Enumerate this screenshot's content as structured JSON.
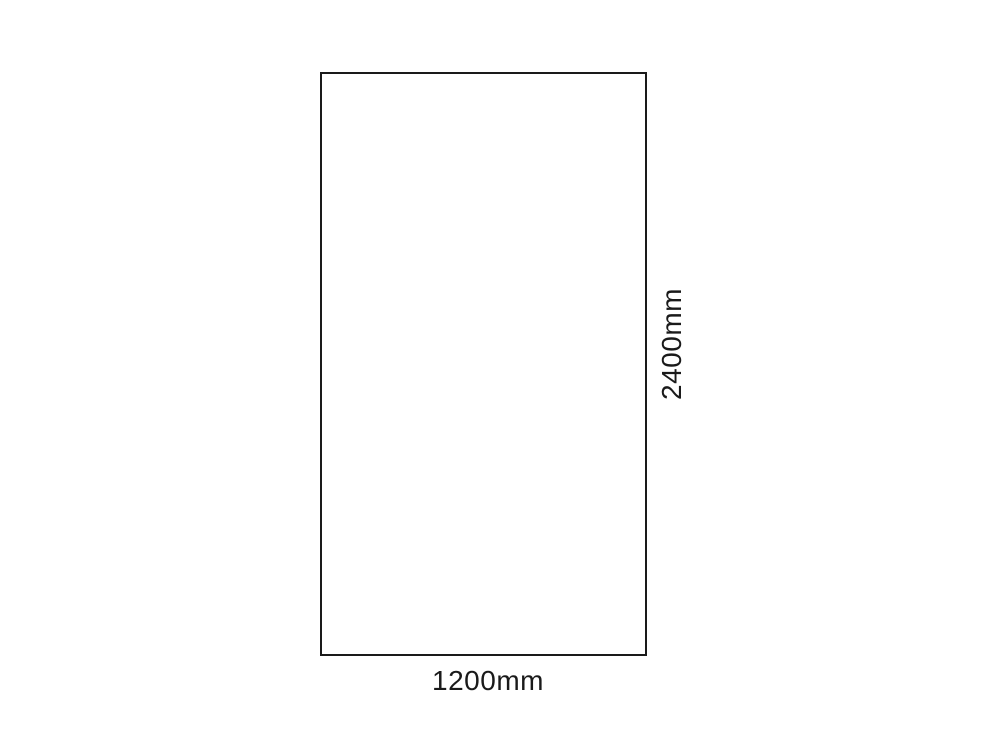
{
  "diagram": {
    "type": "dimensioned-rectangle",
    "shape": "rectangle",
    "width_label": "1200mm",
    "height_label": "2400mm",
    "width_value_mm": 1200,
    "height_value_mm": 2400,
    "colors": {
      "background": "#ffffff",
      "border": "#1a1a1a",
      "text": "#1a1a1a"
    }
  }
}
